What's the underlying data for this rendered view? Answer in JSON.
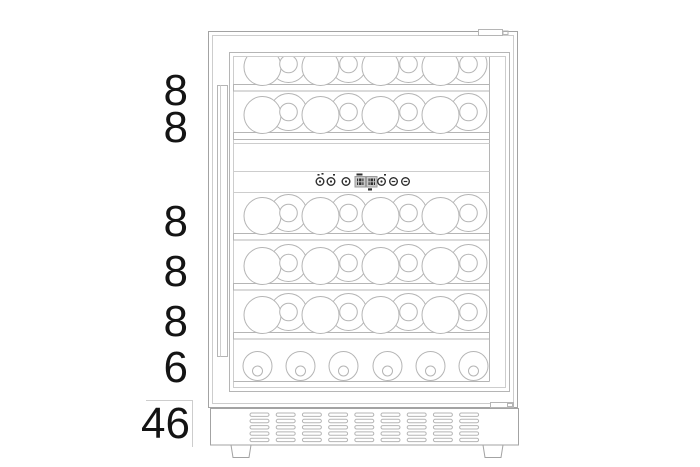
{
  "page": {
    "background": "#ffffff",
    "type": "product-capacity-diagram",
    "subject": "dual-zone wine cooler, front view line drawing"
  },
  "rows": [
    {
      "label": "8",
      "bottles": 8,
      "orientation": "lying",
      "zone": "upper"
    },
    {
      "label": "8",
      "bottles": 8,
      "orientation": "lying",
      "zone": "upper"
    },
    {
      "label": "8",
      "bottles": 8,
      "orientation": "lying",
      "zone": "lower"
    },
    {
      "label": "8",
      "bottles": 8,
      "orientation": "lying",
      "zone": "lower"
    },
    {
      "label": "8",
      "bottles": 8,
      "orientation": "lying",
      "zone": "lower"
    },
    {
      "label": "6",
      "bottles": 6,
      "orientation": "standing",
      "zone": "lower"
    }
  ],
  "total": {
    "label": "46"
  },
  "control_panel": {
    "glyphs": [
      "dot",
      "dot",
      "dot",
      "display",
      "display",
      "dot",
      "minus",
      "minus"
    ]
  },
  "vent_grille": {
    "columns": 9,
    "rows": 5
  },
  "feet_count": 2,
  "colors": {
    "line": "#b5b5b5",
    "line_dark": "#a3a3a3",
    "line_light": "#cdcdcd",
    "text": "#141414",
    "control_dark": "#2e2e2e",
    "display_bg": "#c9c9c9",
    "display_border": "#9b9b9b"
  }
}
